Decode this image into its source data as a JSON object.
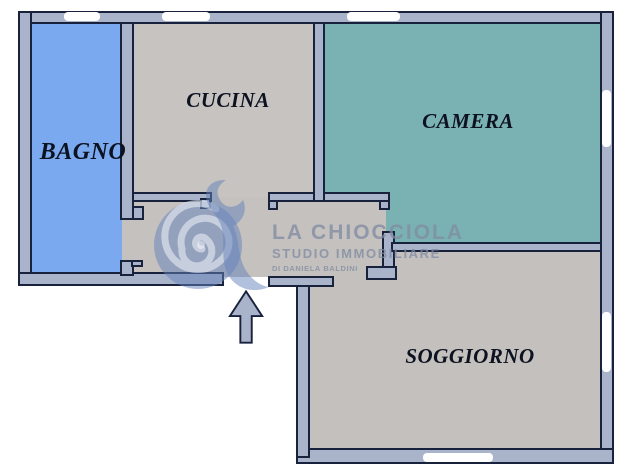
{
  "floorplan": {
    "rooms": [
      {
        "id": "bagno",
        "label": "BAGNO"
      },
      {
        "id": "cucina",
        "label": "CUCINA"
      },
      {
        "id": "camera",
        "label": "CAMERA"
      },
      {
        "id": "soggiorno",
        "label": "SOGGIORNO"
      }
    ],
    "entrance_arrow_direction": "up",
    "colors": {
      "exterior": "#ffffff",
      "wall": "#a9b3ca",
      "outline": "#18223c",
      "bagno": "#7aa9f0",
      "cucina": "#c6c3c0",
      "camera": "#7ab1b2",
      "soggiorno": "#c3c0bd",
      "hall": "#c4c1be",
      "label": "#0d1220",
      "watermark": "rgba(128,140,162,0.78)",
      "wmlogo": "rgba(100,130,186,0.50)",
      "wmspiral": "rgba(240,244,250,0.55)"
    }
  },
  "watermark": {
    "logo_icon": "snail-spiral-logo",
    "line1": "LA CHIOCCIOLA",
    "line2": "STUDIO IMMOBILIARE",
    "line3": "DI DANIELA BALDINI"
  }
}
